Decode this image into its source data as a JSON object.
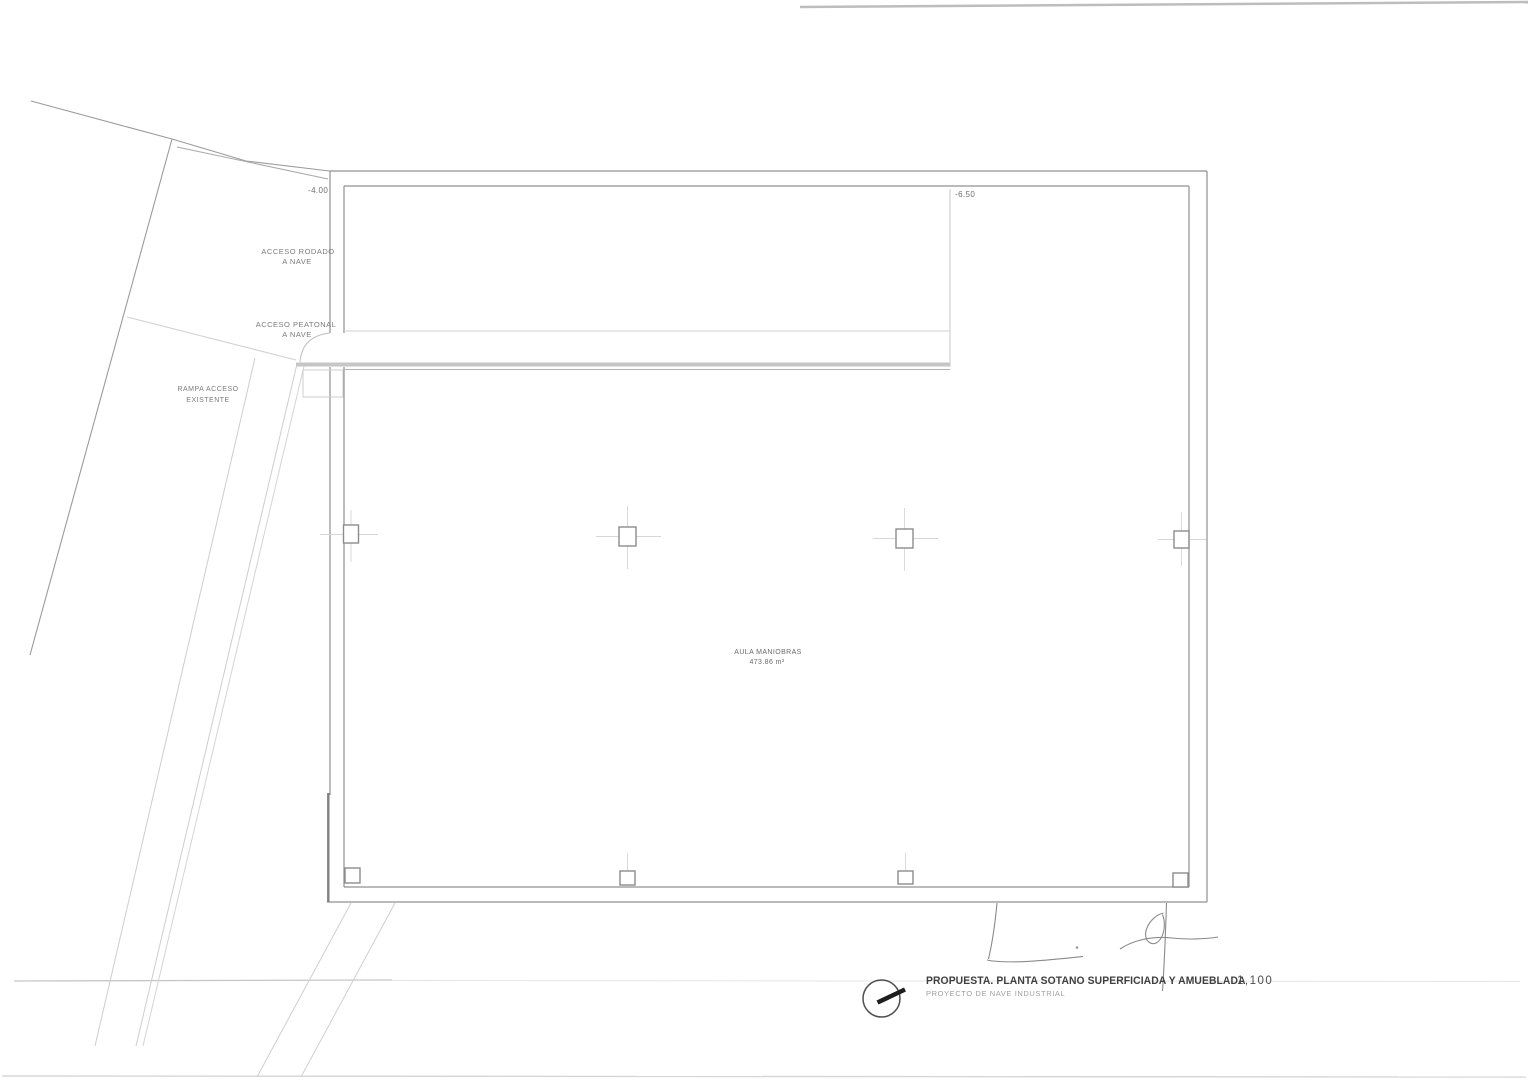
{
  "plan": {
    "levels": {
      "left": "-4.00",
      "right": "-6.50"
    },
    "labels": {
      "acceso_rodado_1": "ACCESO RODADO",
      "acceso_rodado_2": "A NAVE",
      "acceso_peatonal_1": "ACCESO PEATONAL",
      "acceso_peatonal_2": "A NAVE",
      "rampa_1": "RAMPA ACCESO",
      "rampa_2": "EXISTENTE",
      "room_name": "AULA MANIOBRAS",
      "room_area": "473.86 m²"
    }
  },
  "title_block": {
    "title": "PROPUESTA. PLANTA SOTANO SUPERFICIADA Y AMUEBLADA",
    "subtitle": "PROYECTO DE NAVE INDUSTRIAL",
    "scale": "1,100",
    "north_icon": "compass-needle-icon"
  },
  "colors": {
    "paper": "#ffffff",
    "wall_line": "#909090",
    "light_line": "#cdcdcd",
    "text_dark": "#3f3f3f",
    "text_mid": "#7b7b7b"
  }
}
